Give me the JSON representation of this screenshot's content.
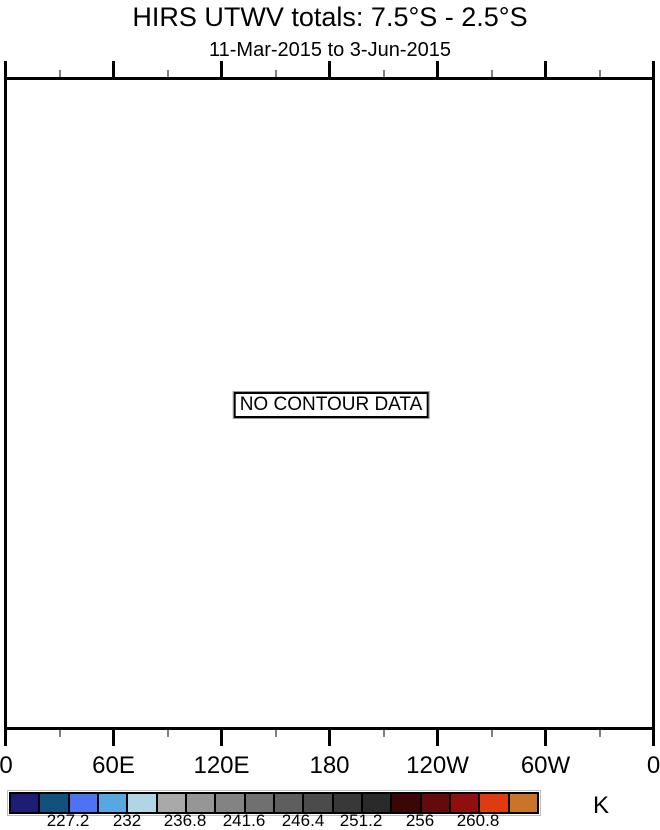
{
  "header": {
    "title": "HIRS UTWV totals: 7.5°S - 2.5°S",
    "subtitle": "11-Mar-2015 to 3-Jun-2015"
  },
  "plot": {
    "no_data_message": "NO CONTOUR DATA"
  },
  "x_axis": {
    "tick_labels": [
      "0",
      "60E",
      "120E",
      "180",
      "120W",
      "60W",
      "0"
    ]
  },
  "colorbar": {
    "unit_label": "K",
    "tick_labels": [
      "227.2",
      "232",
      "236.8",
      "241.6",
      "246.4",
      "251.2",
      "256",
      "260.8"
    ],
    "segment_colors": [
      "#1d1d73",
      "#12517e",
      "#4d73f2",
      "#57a8e0",
      "#b0d6e6",
      "#a9a9a9",
      "#969696",
      "#838383",
      "#707070",
      "#5e5e5e",
      "#4b4b4b",
      "#383838",
      "#2a2a2a",
      "#3a0606",
      "#630a0a",
      "#8f0e0e",
      "#df3a10",
      "#c97428"
    ]
  },
  "chart_data": {
    "type": "heatmap",
    "title": "HIRS UTWV totals: 7.5°S - 2.5°S",
    "subtitle": "11-Mar-2015 to 3-Jun-2015",
    "xlabel": "",
    "ylabel": "",
    "x_tick_labels": [
      "0",
      "60E",
      "120E",
      "180",
      "120W",
      "60W",
      "0"
    ],
    "x_range": "0 to 360 degrees longitude",
    "grid": false,
    "values": [],
    "no_data": true,
    "annotation": "NO CONTOUR DATA",
    "colorbar": {
      "unit": "K",
      "labeled_levels": [
        227.2,
        232,
        236.8,
        241.6,
        246.4,
        251.2,
        256,
        260.8
      ],
      "level_step": 2.4,
      "segment_count": 18,
      "segment_colors": [
        "#1d1d73",
        "#12517e",
        "#4d73f2",
        "#57a8e0",
        "#b0d6e6",
        "#a9a9a9",
        "#969696",
        "#838383",
        "#707070",
        "#5e5e5e",
        "#4b4b4b",
        "#383838",
        "#2a2a2a",
        "#3a0606",
        "#630a0a",
        "#8f0e0e",
        "#df3a10",
        "#c97428"
      ],
      "position": "bottom"
    }
  }
}
